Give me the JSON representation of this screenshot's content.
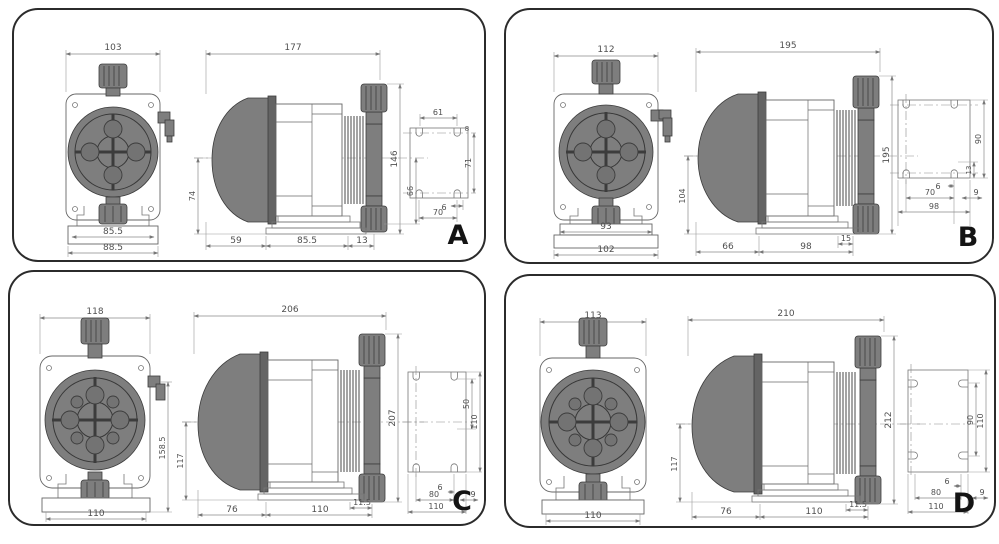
{
  "panels": [
    {
      "letter": "A",
      "front": {
        "top_width": "103",
        "base_inner": "85.5",
        "base_outer": "88.5"
      },
      "side": {
        "top_width": "177",
        "left_height": "74",
        "right_height": "146",
        "inner_height": "66",
        "bottom_1": "59",
        "bottom_2": "85.5",
        "bottom_3": "13"
      },
      "plate": {
        "top_width": "61",
        "slot_width": "8",
        "right_height": "71",
        "hole_offset": "6",
        "hole_spacing": "70"
      }
    },
    {
      "letter": "B",
      "front": {
        "top_width": "112",
        "base_inner": "93",
        "base_outer": "102"
      },
      "side": {
        "top_width": "195",
        "left_height": "104",
        "right_height": "195",
        "foot_offset": "15",
        "bottom_1": "66",
        "bottom_2": "98"
      },
      "plate": {
        "slot_height": "90",
        "corner_offset": "13",
        "hole_offset": "6",
        "hole_spacing": "70",
        "width": "98",
        "side_offset": "9"
      }
    },
    {
      "letter": "C",
      "front": {
        "top_width": "118",
        "right_height": "158.5",
        "base_width": "110"
      },
      "side": {
        "top_width": "206",
        "left_height": "117",
        "right_height": "207",
        "foot_offset": "11.5",
        "bottom_1": "76",
        "bottom_2": "110"
      },
      "plate": {
        "inner_height": "50",
        "outer_height": "110",
        "hole_offset": "6",
        "hole_spacing": "80",
        "width": "110",
        "side_offset": "9"
      }
    },
    {
      "letter": "D",
      "front": {
        "top_width": "113",
        "base_width": "110"
      },
      "side": {
        "top_width": "210",
        "left_height": "117",
        "right_height": "212",
        "foot_offset": "11.5",
        "bottom_1": "76",
        "bottom_2": "110"
      },
      "plate": {
        "inner_height": "90",
        "outer_height": "110",
        "hole_offset": "6",
        "hole_spacing": "80",
        "width": "110",
        "side_offset": "9"
      }
    }
  ]
}
